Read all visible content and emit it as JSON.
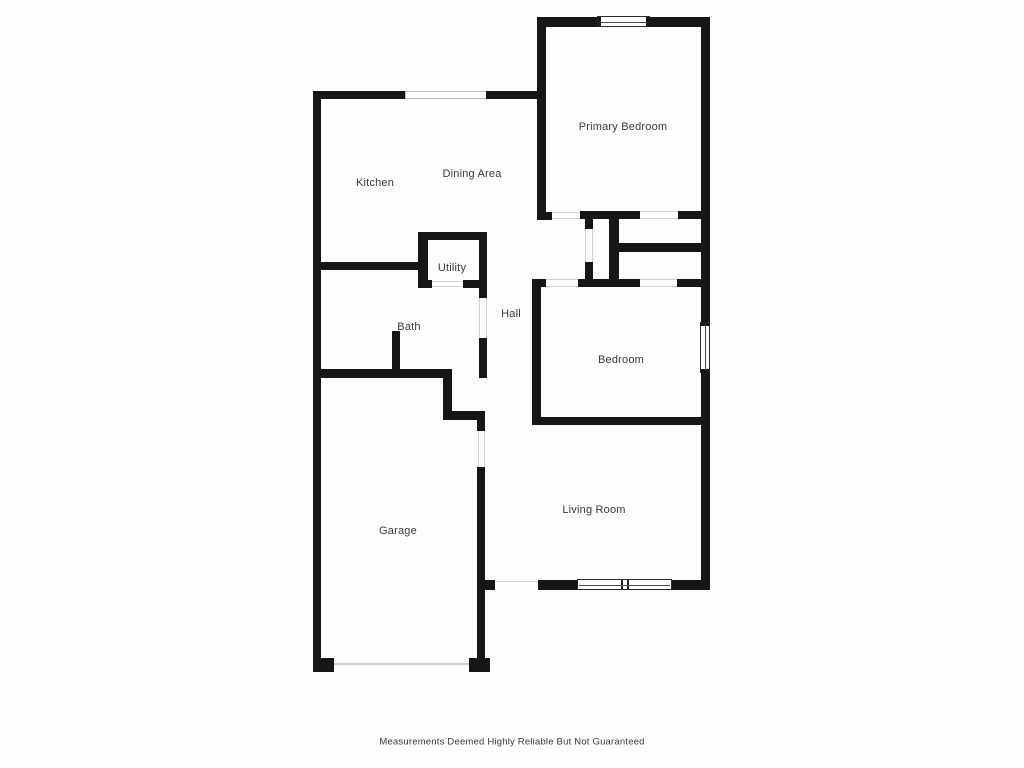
{
  "floorplan": {
    "rooms": {
      "primary_bedroom": "Primary Bedroom",
      "kitchen": "Kitchen",
      "dining_area": "Dining Area",
      "utility": "Utility",
      "bath": "Bath",
      "hall": "Hall",
      "bedroom": "Bedroom",
      "garage": "Garage",
      "living_room": "Living Room"
    },
    "disclaimer": "Measurements Deemed Highly Reliable But Not Guaranteed",
    "colors": {
      "wall": "#161616",
      "background": "#fdfdfd",
      "label_text": "#3b3b3b"
    }
  }
}
